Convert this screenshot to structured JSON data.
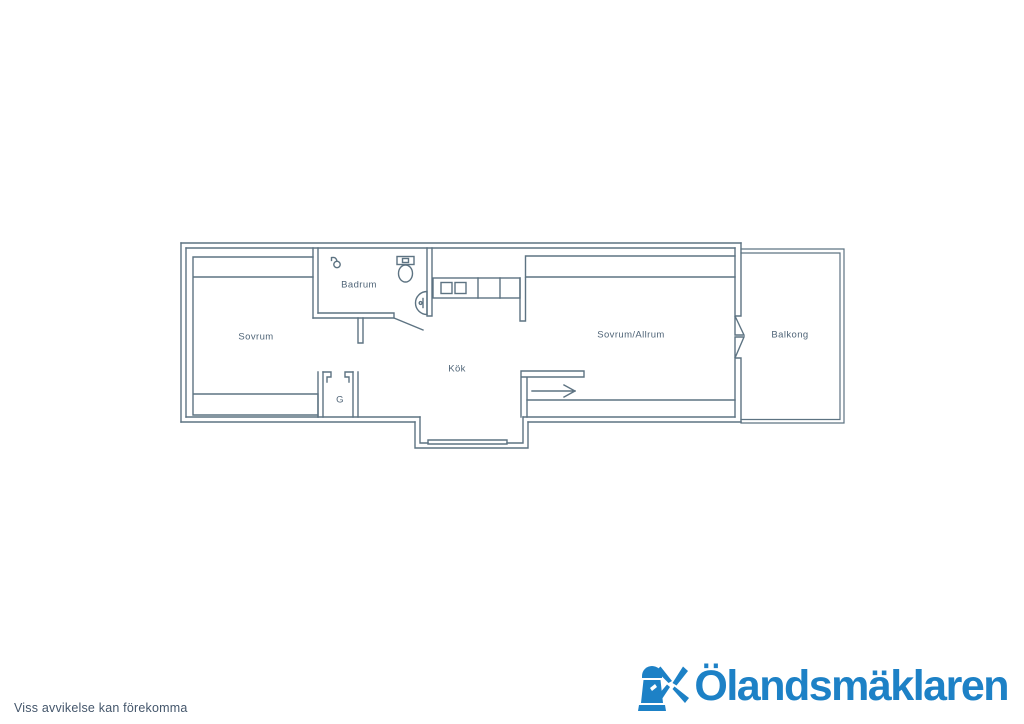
{
  "floorplan": {
    "labels": {
      "sovrum": "Sovrum",
      "badrum": "Badrum",
      "kok": "Kök",
      "closet": "G",
      "sovrum_allrum": "Sovrum/Allrum",
      "balkong": "Balkong"
    },
    "fixtures": [
      "shower-icon",
      "toilet-icon",
      "sink-icon",
      "stove-icon",
      "entry-arrow",
      "balcony-door",
      "window"
    ],
    "line_color": "#5d7382",
    "label_color": "#4f6477"
  },
  "footer": {
    "disclaimer": "Viss avvikelse kan förekomma",
    "text_color": "#44566b"
  },
  "logo": {
    "name": "Ölandsmäklaren",
    "icon": "windmill-icon",
    "color": "#1d81c6"
  }
}
